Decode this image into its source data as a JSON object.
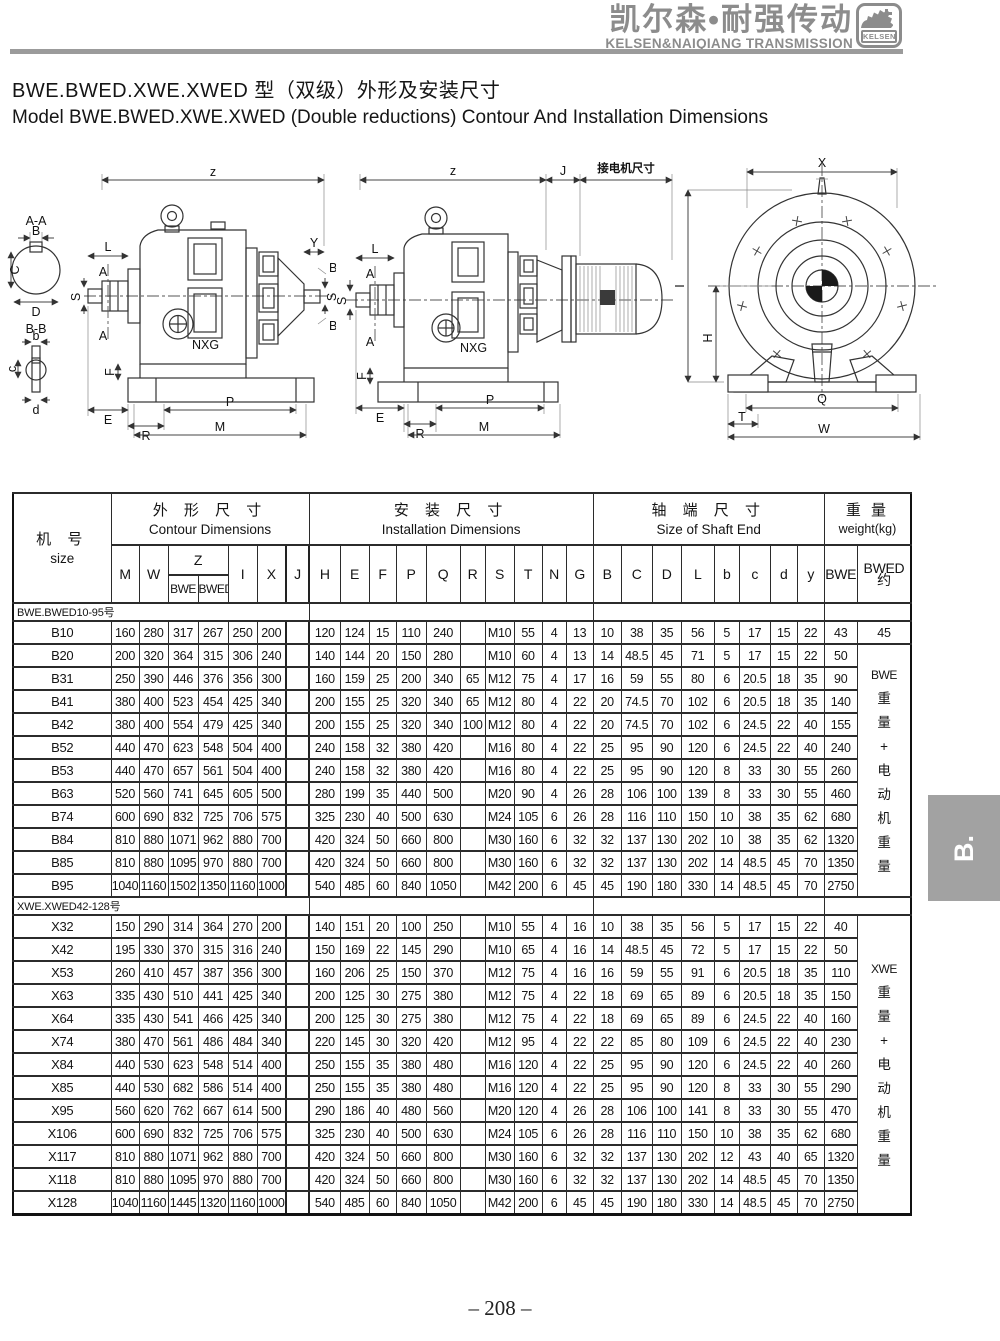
{
  "header": {
    "brand_cn": "凯尔森•耐强传动",
    "brand_en": "KELSEN&NAIQIANG TRANSMISSION",
    "logo_text": "KELSEN"
  },
  "title": {
    "cn": "BWE.BWED.XWE.XWED 型（双级）外形及安装尺寸",
    "en": "Model BWE.BWED.XWE.XWED (Double reductions) Contour And Installation Dimensions"
  },
  "diagrams": {
    "side_view": {
      "z": "z",
      "L": "L",
      "A_top": "A",
      "A_bottom": "A",
      "Y": "Y",
      "B_right_top": "B",
      "B_right_bottom": "B",
      "S_left": "S",
      "S_right": "S",
      "section_aa": "A-A",
      "B_key": "B",
      "C": "C",
      "D": "D",
      "section_bb": "B-B",
      "b": "b",
      "c": "c",
      "d": "d",
      "NXG": "NXG",
      "F": "F",
      "E": "E",
      "R": "R",
      "P": "P",
      "M": "M"
    },
    "side_view_motor": {
      "z": "z",
      "J": "J",
      "motor_dim_note": "接电机尺寸",
      "L": "L",
      "A_top": "A",
      "A_bottom": "A",
      "S": "S",
      "NXG": "NXG",
      "F": "F",
      "E": "E",
      "R": "R",
      "P": "P",
      "M": "M"
    },
    "front_view": {
      "X": "X",
      "I": "I",
      "H": "H",
      "Q": "Q",
      "T": "T",
      "W": "W"
    }
  },
  "table": {
    "headers": {
      "size_cn": "机  号",
      "size_en": "size",
      "g1_cn": "外 形 尺 寸",
      "g1_en": "Contour Dimensions",
      "g2_cn": "安 装 尺 寸",
      "g2_en": "Installation Dimensions",
      "g3_cn": "轴 端 尺 寸",
      "g3_en": "Size of Shaft End",
      "g4_cn": "重 量",
      "g4_en": "weight(kg)"
    },
    "cols": [
      "M",
      "W",
      "Z",
      "BWE",
      "BWED",
      "I",
      "X",
      "J",
      "H",
      "E",
      "F",
      "P",
      "Q",
      "R",
      "S",
      "T",
      "N",
      "G",
      "B",
      "C",
      "D",
      "L",
      "b",
      "c",
      "d",
      "y",
      "BWE",
      "BWED",
      "约"
    ],
    "sections": [
      {
        "label": "BWE.BWED10-95号",
        "note": {
          "start_row": 1,
          "lines": [
            "BWE",
            "重",
            "量",
            "+",
            "电",
            "动",
            "机",
            "重",
            "量"
          ]
        },
        "rows": [
          {
            "size": "B10",
            "vals": [
              "160",
              "280",
              "317",
              "267",
              "250",
              "200",
              "",
              "120",
              "124",
              "15",
              "110",
              "240",
              "",
              "M10",
              "55",
              "4",
              "13",
              "10",
              "38",
              "35",
              "56",
              "5",
              "17",
              "15",
              "22",
              "43",
              "45"
            ]
          },
          {
            "size": "B20",
            "vals": [
              "200",
              "320",
              "364",
              "315",
              "306",
              "240",
              "",
              "140",
              "144",
              "20",
              "150",
              "280",
              "",
              "M10",
              "60",
              "4",
              "13",
              "14",
              "48.5",
              "45",
              "71",
              "5",
              "17",
              "15",
              "22",
              "50"
            ]
          },
          {
            "size": "B31",
            "vals": [
              "250",
              "390",
              "446",
              "376",
              "356",
              "300",
              "",
              "160",
              "159",
              "25",
              "200",
              "340",
              "65",
              "M12",
              "75",
              "4",
              "17",
              "16",
              "59",
              "55",
              "80",
              "6",
              "20.5",
              "18",
              "35",
              "90"
            ]
          },
          {
            "size": "B41",
            "vals": [
              "380",
              "400",
              "523",
              "454",
              "425",
              "340",
              "",
              "200",
              "155",
              "25",
              "320",
              "340",
              "65",
              "M12",
              "80",
              "4",
              "22",
              "20",
              "74.5",
              "70",
              "102",
              "6",
              "20.5",
              "18",
              "35",
              "140"
            ]
          },
          {
            "size": "B42",
            "vals": [
              "380",
              "400",
              "554",
              "479",
              "425",
              "340",
              "",
              "200",
              "155",
              "25",
              "320",
              "340",
              "100",
              "M12",
              "80",
              "4",
              "22",
              "20",
              "74.5",
              "70",
              "102",
              "6",
              "24.5",
              "22",
              "40",
              "155"
            ]
          },
          {
            "size": "B52",
            "vals": [
              "440",
              "470",
              "623",
              "548",
              "504",
              "400",
              "",
              "240",
              "158",
              "32",
              "380",
              "420",
              "",
              "M16",
              "80",
              "4",
              "22",
              "25",
              "95",
              "90",
              "120",
              "6",
              "24.5",
              "22",
              "40",
              "240"
            ]
          },
          {
            "size": "B53",
            "vals": [
              "440",
              "470",
              "657",
              "561",
              "504",
              "400",
              "",
              "240",
              "158",
              "32",
              "380",
              "420",
              "",
              "M16",
              "80",
              "4",
              "22",
              "25",
              "95",
              "90",
              "120",
              "8",
              "33",
              "30",
              "55",
              "260"
            ]
          },
          {
            "size": "B63",
            "vals": [
              "520",
              "560",
              "741",
              "645",
              "605",
              "500",
              "",
              "280",
              "199",
              "35",
              "440",
              "500",
              "",
              "M20",
              "90",
              "4",
              "26",
              "28",
              "106",
              "100",
              "139",
              "8",
              "33",
              "30",
              "55",
              "460"
            ]
          },
          {
            "size": "B74",
            "vals": [
              "600",
              "690",
              "832",
              "725",
              "706",
              "575",
              "",
              "325",
              "230",
              "40",
              "500",
              "630",
              "",
              "M24",
              "105",
              "6",
              "26",
              "28",
              "116",
              "110",
              "150",
              "10",
              "38",
              "35",
              "62",
              "680"
            ]
          },
          {
            "size": "B84",
            "vals": [
              "810",
              "880",
              "1071",
              "962",
              "880",
              "700",
              "",
              "420",
              "324",
              "50",
              "660",
              "800",
              "",
              "M30",
              "160",
              "6",
              "32",
              "32",
              "137",
              "130",
              "202",
              "10",
              "38",
              "35",
              "62",
              "1320"
            ]
          },
          {
            "size": "B85",
            "vals": [
              "810",
              "880",
              "1095",
              "970",
              "880",
              "700",
              "",
              "420",
              "324",
              "50",
              "660",
              "800",
              "",
              "M30",
              "160",
              "6",
              "32",
              "32",
              "137",
              "130",
              "202",
              "14",
              "48.5",
              "45",
              "70",
              "1350"
            ]
          },
          {
            "size": "B95",
            "vals": [
              "1040",
              "1160",
              "1502",
              "1350",
              "1160",
              "1000",
              "",
              "540",
              "485",
              "60",
              "840",
              "1050",
              "",
              "M42",
              "200",
              "6",
              "45",
              "45",
              "190",
              "180",
              "330",
              "14",
              "48.5",
              "45",
              "70",
              "2750"
            ]
          }
        ]
      },
      {
        "label": "XWE.XWED42-128号",
        "note": {
          "start_row": 0,
          "lines": [
            "XWE",
            "重",
            "量",
            "+",
            "电",
            "动",
            "机",
            "重",
            "量"
          ]
        },
        "rows": [
          {
            "size": "X32",
            "vals": [
              "150",
              "290",
              "314",
              "364",
              "270",
              "200",
              "",
              "140",
              "151",
              "20",
              "100",
              "250",
              "",
              "M10",
              "55",
              "4",
              "16",
              "10",
              "38",
              "35",
              "56",
              "5",
              "17",
              "15",
              "22",
              "40"
            ]
          },
          {
            "size": "X42",
            "vals": [
              "195",
              "330",
              "370",
              "315",
              "316",
              "240",
              "",
              "150",
              "169",
              "22",
              "145",
              "290",
              "",
              "M10",
              "65",
              "4",
              "16",
              "14",
              "48.5",
              "45",
              "72",
              "5",
              "17",
              "15",
              "22",
              "50"
            ]
          },
          {
            "size": "X53",
            "vals": [
              "260",
              "410",
              "457",
              "387",
              "356",
              "300",
              "",
              "160",
              "206",
              "25",
              "150",
              "370",
              "",
              "M12",
              "75",
              "4",
              "16",
              "16",
              "59",
              "55",
              "91",
              "6",
              "20.5",
              "18",
              "35",
              "110"
            ]
          },
          {
            "size": "X63",
            "vals": [
              "335",
              "430",
              "510",
              "441",
              "425",
              "340",
              "",
              "200",
              "125",
              "30",
              "275",
              "380",
              "",
              "M12",
              "75",
              "4",
              "22",
              "18",
              "69",
              "65",
              "89",
              "6",
              "20.5",
              "18",
              "35",
              "150"
            ]
          },
          {
            "size": "X64",
            "vals": [
              "335",
              "430",
              "541",
              "466",
              "425",
              "340",
              "",
              "200",
              "125",
              "30",
              "275",
              "380",
              "",
              "M12",
              "75",
              "4",
              "22",
              "18",
              "69",
              "65",
              "89",
              "6",
              "24.5",
              "22",
              "40",
              "160"
            ]
          },
          {
            "size": "X74",
            "vals": [
              "380",
              "470",
              "561",
              "486",
              "484",
              "340",
              "",
              "220",
              "145",
              "30",
              "320",
              "420",
              "",
              "M12",
              "95",
              "4",
              "22",
              "22",
              "85",
              "80",
              "109",
              "6",
              "24.5",
              "22",
              "40",
              "230"
            ]
          },
          {
            "size": "X84",
            "vals": [
              "440",
              "530",
              "623",
              "548",
              "514",
              "400",
              "",
              "250",
              "155",
              "35",
              "380",
              "480",
              "",
              "M16",
              "120",
              "4",
              "22",
              "25",
              "95",
              "90",
              "120",
              "6",
              "24.5",
              "22",
              "40",
              "260"
            ]
          },
          {
            "size": "X85",
            "vals": [
              "440",
              "530",
              "682",
              "586",
              "514",
              "400",
              "",
              "250",
              "155",
              "35",
              "380",
              "480",
              "",
              "M16",
              "120",
              "4",
              "22",
              "25",
              "95",
              "90",
              "120",
              "8",
              "33",
              "30",
              "55",
              "290"
            ]
          },
          {
            "size": "X95",
            "vals": [
              "560",
              "620",
              "762",
              "667",
              "614",
              "500",
              "",
              "290",
              "186",
              "40",
              "480",
              "560",
              "",
              "M20",
              "120",
              "4",
              "26",
              "28",
              "106",
              "100",
              "141",
              "8",
              "33",
              "30",
              "55",
              "470"
            ]
          },
          {
            "size": "X106",
            "vals": [
              "600",
              "690",
              "832",
              "725",
              "706",
              "575",
              "",
              "325",
              "230",
              "40",
              "500",
              "630",
              "",
              "M24",
              "105",
              "6",
              "26",
              "28",
              "116",
              "110",
              "150",
              "10",
              "38",
              "35",
              "62",
              "680"
            ]
          },
          {
            "size": "X117",
            "vals": [
              "810",
              "880",
              "1071",
              "962",
              "880",
              "700",
              "",
              "420",
              "324",
              "50",
              "660",
              "800",
              "",
              "M30",
              "160",
              "6",
              "32",
              "32",
              "137",
              "130",
              "202",
              "12",
              "43",
              "40",
              "65",
              "1320"
            ]
          },
          {
            "size": "X118",
            "vals": [
              "810",
              "880",
              "1095",
              "970",
              "880",
              "700",
              "",
              "420",
              "324",
              "50",
              "660",
              "800",
              "",
              "M30",
              "160",
              "6",
              "32",
              "32",
              "137",
              "130",
              "202",
              "14",
              "48.5",
              "45",
              "70",
              "1350"
            ]
          },
          {
            "size": "X128",
            "vals": [
              "1040",
              "1160",
              "1445",
              "1320",
              "1160",
              "1000",
              "",
              "540",
              "485",
              "60",
              "840",
              "1050",
              "",
              "M42",
              "200",
              "6",
              "45",
              "45",
              "190",
              "180",
              "330",
              "14",
              "48.5",
              "45",
              "70",
              "2750"
            ]
          }
        ]
      }
    ]
  },
  "side_tab": "B.",
  "page_number": "– 208 –"
}
